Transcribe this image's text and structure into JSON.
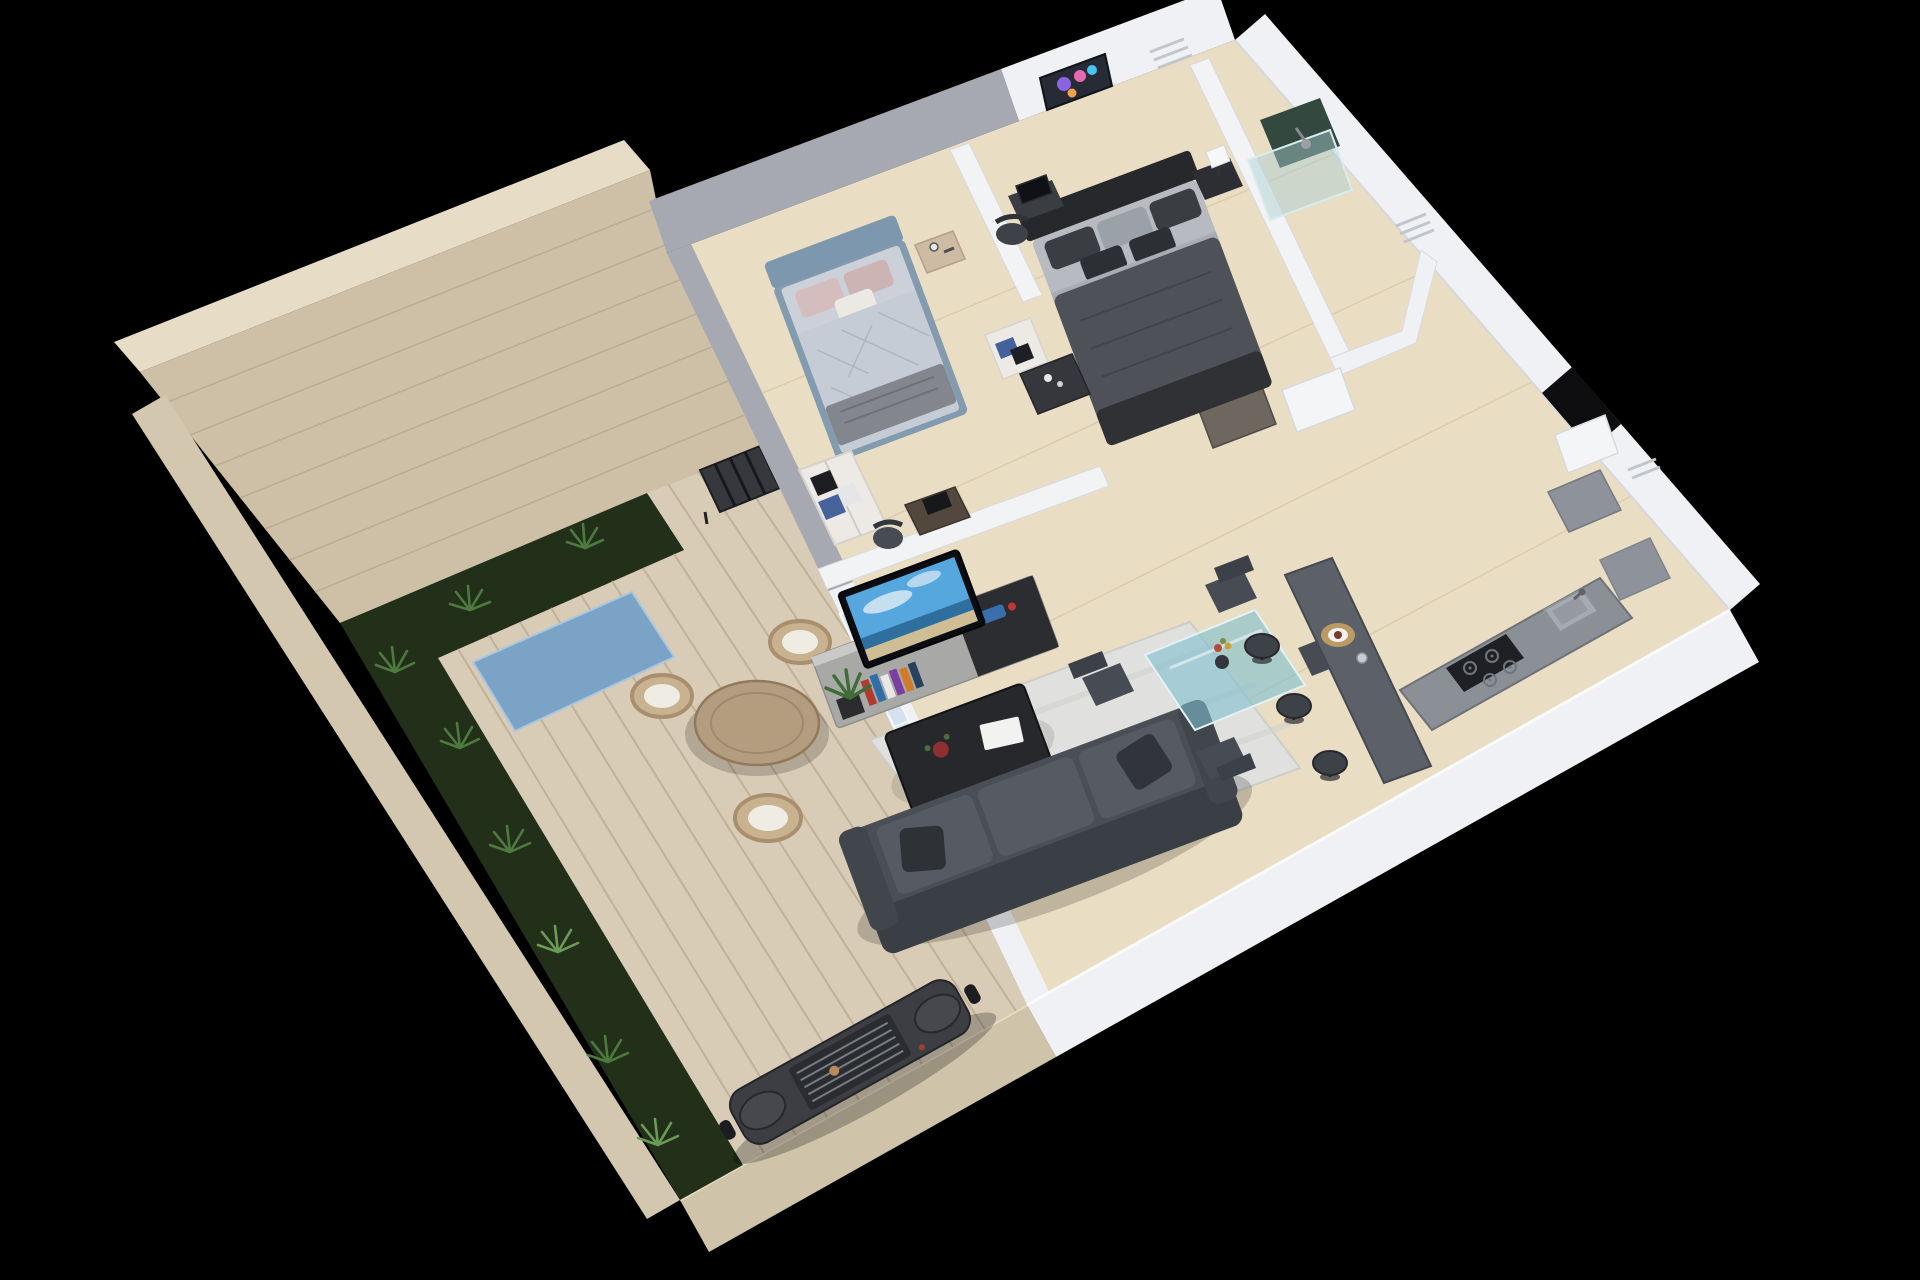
{
  "scene": {
    "type": "3d-isometric-floor-plan-render",
    "view": "aerial cutaway of a one-storey apartment with walled terrace on black background",
    "areas": [
      {
        "name": "terrace",
        "features": [
          "brick boundary wall",
          "garden bed with ferns",
          "wood plank deck",
          "blue outdoor rug",
          "round wooden table",
          "three wicker chairs with white cushions",
          "storage rack",
          "barbecue grill"
        ]
      },
      {
        "name": "bedroom-2",
        "features": [
          "blue upholstered bed",
          "diamond-quilted light duvet",
          "pink pillows",
          "gray throw",
          "wooden nightstand",
          "open wardrobe with folded clothes",
          "desk with laptop",
          "desk chair"
        ]
      },
      {
        "name": "master-bedroom",
        "features": [
          "black headboard double bed",
          "dark gray duvet",
          "gray and black pillows",
          "nightstand with white cube lamp",
          "colorful wall artwork",
          "desk with monitor",
          "office chair",
          "open shelf unit",
          "dark dresser"
        ]
      },
      {
        "name": "living-room",
        "features": [
          "wall-mounted tv showing beach scene",
          "media console with books and game console",
          "potted plant",
          "black coffee table with book and flower",
          "textured area rug",
          "dark gray sofa with cushions",
          "sliding glass door to terrace"
        ]
      },
      {
        "name": "dining-area",
        "features": [
          "teal glass dining table",
          "four dark chairs",
          "flower vase"
        ]
      },
      {
        "name": "kitchen",
        "features": [
          "dark breakfast bar with place setting",
          "three bar stools",
          "counter with sink and faucet",
          "gas cooktop with four burners",
          "tall gray cabinet"
        ]
      },
      {
        "name": "bathroom",
        "features": [
          "glass shower enclosure",
          "dark green tiled shower wall",
          "shower head",
          "white door ajar"
        ]
      },
      {
        "name": "hallway",
        "features": [
          "open gray-brown interior door",
          "dark entrance opening",
          "white door",
          "wall ventilation grilles"
        ]
      }
    ]
  },
  "colors": {
    "background": "#000000",
    "brick_wall": "#cdc0a6",
    "brick_wall_top": "#e7ddc7",
    "brick_seam": "#b4a78e",
    "outer_wall": "#d3c7af",
    "terrace_wall": "#cfc3aa",
    "garden": "#22301a",
    "fern": "#4d7a3e",
    "deck": "#d9ccb6",
    "deck_seam": "#bcae95",
    "outdoor_rug": "#7ba3c6",
    "table_wood": "#b49d7e",
    "wicker": "#c9b28f",
    "cushion": "#efece3",
    "grill_body": "#3c3e43",
    "floor": "#e9ddc3",
    "floor_seam": "#d9c8a6",
    "wall_white": "#f0f1f4",
    "wall_gray": "#a6a8b2",
    "glass": "#bcd6e9",
    "bed2_frame": "#7d97ae",
    "bed2_mattress": "#ccd1d9",
    "bed2_duvet": "#c5ccd5",
    "pillow_pink": "#d6bdbd",
    "throw_gray": "#83868d",
    "master_headboard": "#26282c",
    "master_mattress": "#b7bac0",
    "master_duvet": "#4e5158",
    "nightstand_dark": "#2c2e33",
    "wood_light": "#cdbba3",
    "wardrobe": "#edeae5",
    "lamp": "#f7f7f7",
    "artwork_bg": "#262b36",
    "tv_sky": "#56a7de",
    "tv_sea": "#2e6f9e",
    "tv_sand": "#cfbd93",
    "console": "#a8a8a6",
    "console_dark": "#2b2d31",
    "sofa": "#4a4e56",
    "sofa_back": "#3a3e45",
    "sofa_cushion": "#565b63",
    "coffee_table": "#26282b",
    "rug": "#e0e0de",
    "dining_glass": "#7fbfce",
    "chair": "#474c54",
    "bar": "#5c6169",
    "stool": "#3d4148",
    "counter": "#8b9097",
    "cooktop": "#1e2023",
    "sink": "#a6abb2",
    "shower_tile": "#33493f",
    "shower_glass": "#a8ced2",
    "door_master": "#6e675f",
    "door_white": "#f4f5f7",
    "doorway_dark": "#0e0e10",
    "cabinet": "#8e939b",
    "vent": "#c2c6cc",
    "plant_green": "#3f6d36"
  }
}
